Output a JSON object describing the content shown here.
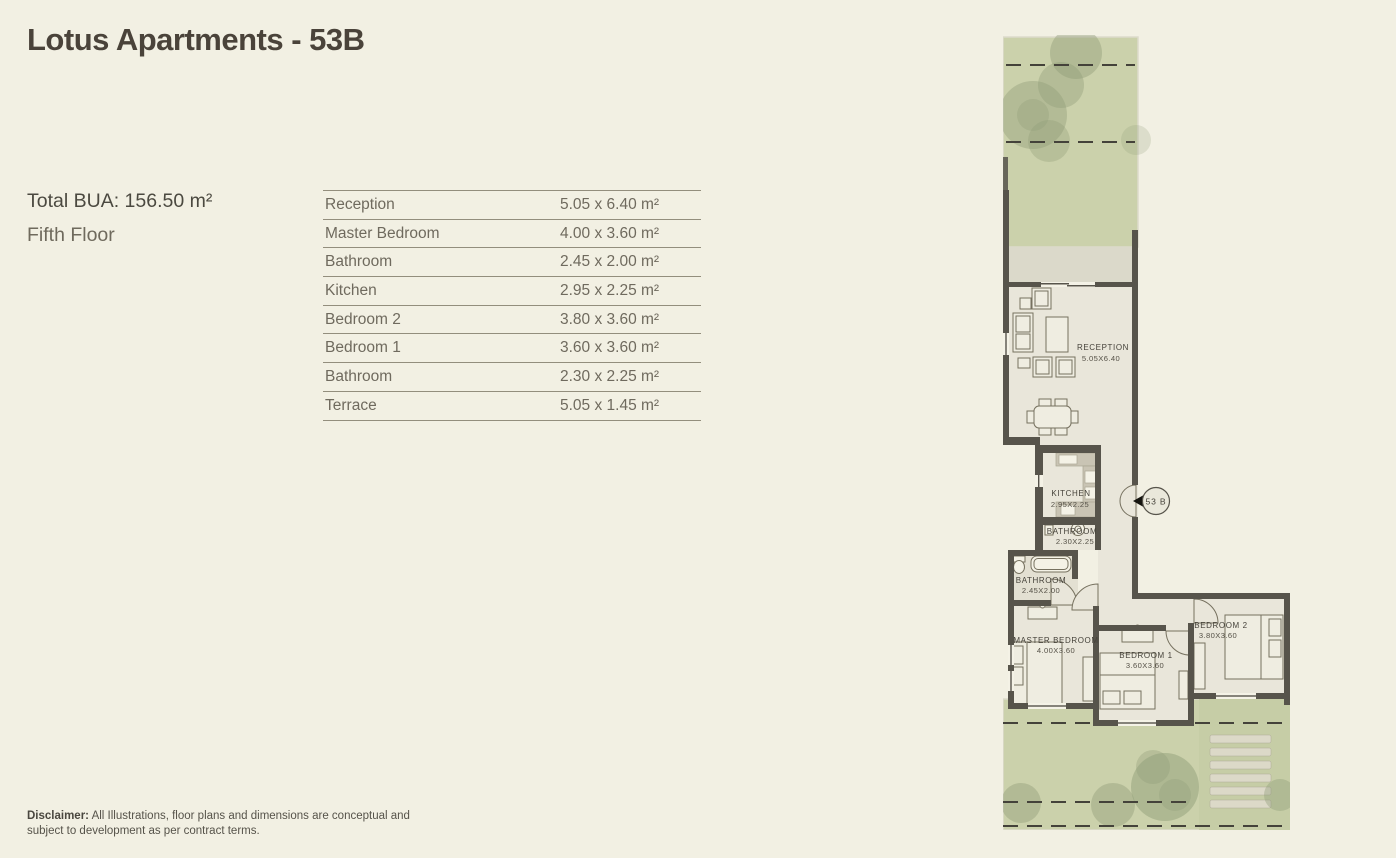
{
  "header": {
    "title": "Lotus Apartments - 53B"
  },
  "info": {
    "total_bua": "Total BUA: 156.50 m²",
    "floor": "Fifth Floor"
  },
  "table": {
    "rows": [
      {
        "name": "Reception",
        "dims": "5.05 x 6.40 m²"
      },
      {
        "name": "Master Bedroom",
        "dims": "4.00 x 3.60 m²"
      },
      {
        "name": "Bathroom",
        "dims": "2.45 x 2.00 m²"
      },
      {
        "name": "Kitchen",
        "dims": "2.95 x 2.25 m²"
      },
      {
        "name": "Bedroom 2",
        "dims": "3.80 x 3.60 m²"
      },
      {
        "name": "Bedroom 1",
        "dims": "3.60 x 3.60  m²"
      },
      {
        "name": "Bathroom",
        "dims": "2.30 x 2.25 m²"
      },
      {
        "name": "Terrace",
        "dims": "5.05 x 1.45  m²"
      }
    ]
  },
  "disclaimer": {
    "bold": "Disclaimer:",
    "text": " All Illustrations, floor plans and dimensions are conceptual and subject to development as per contract terms."
  },
  "plan": {
    "unit_marker": "53 B",
    "labels": {
      "terrace": {
        "name": "TERRACE",
        "dims": "5.05X1.45"
      },
      "reception": {
        "name": "RECEPTION",
        "dims": "5.05X6.40"
      },
      "kitchen": {
        "name": "KITCHEN",
        "dims": "2.95X2.25"
      },
      "bathroom_small": {
        "name": "BATHROOM",
        "dims": "2.30X2.25"
      },
      "bathroom_master": {
        "name": "BATHROOM",
        "dims": "2.45X2.00"
      },
      "master_bedroom": {
        "name": "MASTER BEDROOM",
        "dims": "4.00X3.60"
      },
      "bedroom_1": {
        "name": "BEDROOM 1",
        "dims": "3.60X3.60"
      },
      "bedroom_2": {
        "name": "BEDROOM 2",
        "dims": "3.80X3.60"
      }
    }
  },
  "colors": {
    "page_background": "#f2f0e3",
    "title_text": "#4a433a",
    "body_text": "#6f6a5e",
    "table_line": "#938e7d",
    "wall": "#57544b",
    "floor": "#e9e6da",
    "garden_green": "#cbd1ab",
    "tree_shadow": "#8f9c77",
    "terrace_strip": "#dbd9ca",
    "kitchen_counter": "#c9c4b4"
  }
}
